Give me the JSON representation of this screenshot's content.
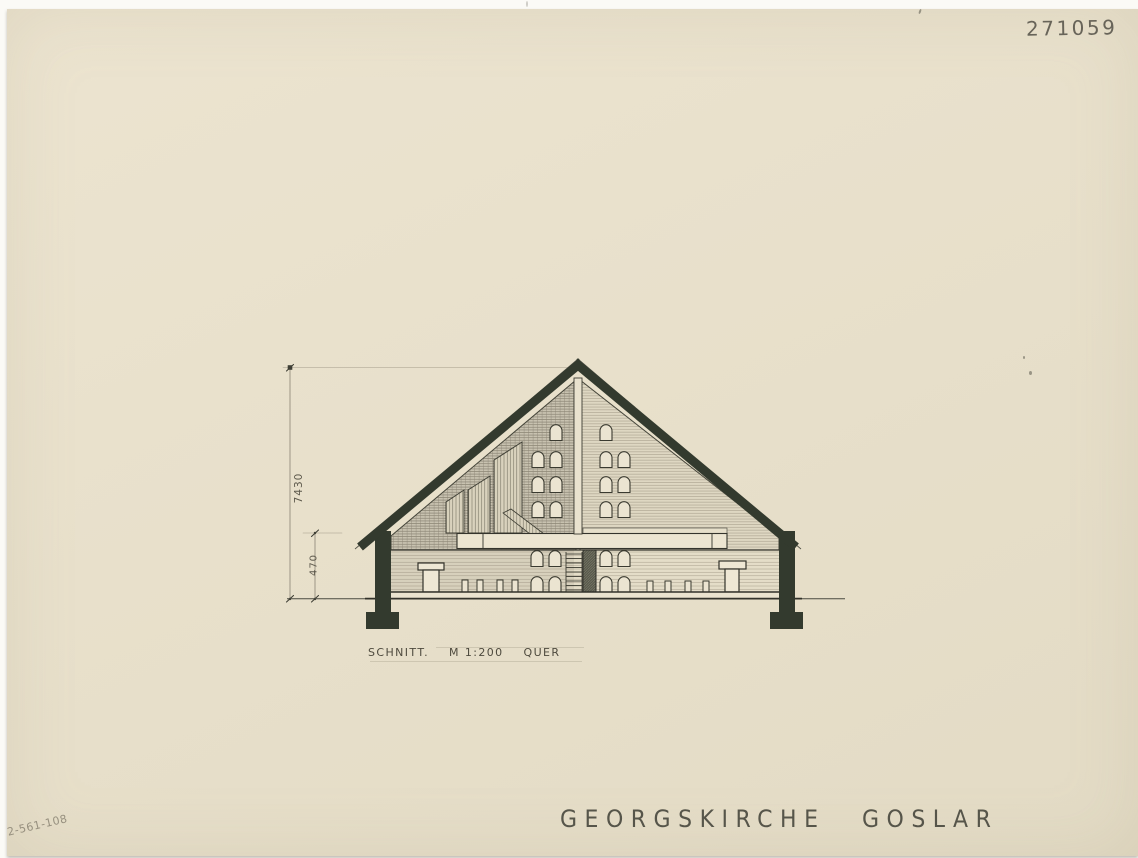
{
  "archive_number": "271059",
  "drawing": {
    "caption": {
      "label": "SCHNITT.",
      "scale": "M 1:200",
      "orientation": "QUER"
    },
    "dimensions": {
      "overall_height": "7430",
      "eave_height": "470"
    }
  },
  "title": "GEORGSKIRCHE GOSLAR",
  "inventory_code": "2-561-108",
  "colors": {
    "paper": "#e8e0cb",
    "ink": "#333a2e",
    "pencil": "#5d594c"
  }
}
